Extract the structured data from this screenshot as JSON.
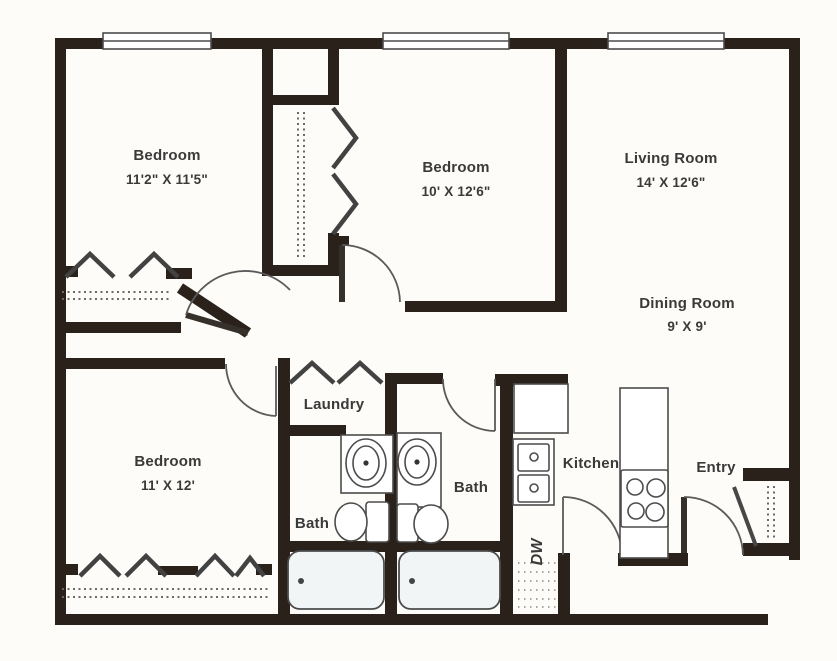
{
  "floor_plan": {
    "type": "apartment-floor-plan",
    "colors": {
      "background": "#fdfcf8",
      "wall": "#2a211b",
      "line": "#4c4c4c",
      "text": "#3a3a3a",
      "tub_fill": "#f2f5f6"
    },
    "rooms": {
      "bedroom_top_left": {
        "label": "Bedroom",
        "dimensions": "11'2\" X 11'5\""
      },
      "bedroom_middle": {
        "label": "Bedroom",
        "dimensions": "10' X 12'6\""
      },
      "living_room": {
        "label": "Living Room",
        "dimensions": "14' X 12'6\""
      },
      "dining_room": {
        "label": "Dining Room",
        "dimensions": "9' X 9'"
      },
      "bedroom_bottom_left": {
        "label": "Bedroom",
        "dimensions": "11' X 12'"
      },
      "laundry": {
        "label": "Laundry"
      },
      "bath_center": {
        "label": "Bath"
      },
      "bath_right": {
        "label": "Bath"
      },
      "kitchen": {
        "label": "Kitchen"
      },
      "entry": {
        "label": "Entry"
      },
      "dishwasher": {
        "label": "DW"
      }
    }
  }
}
